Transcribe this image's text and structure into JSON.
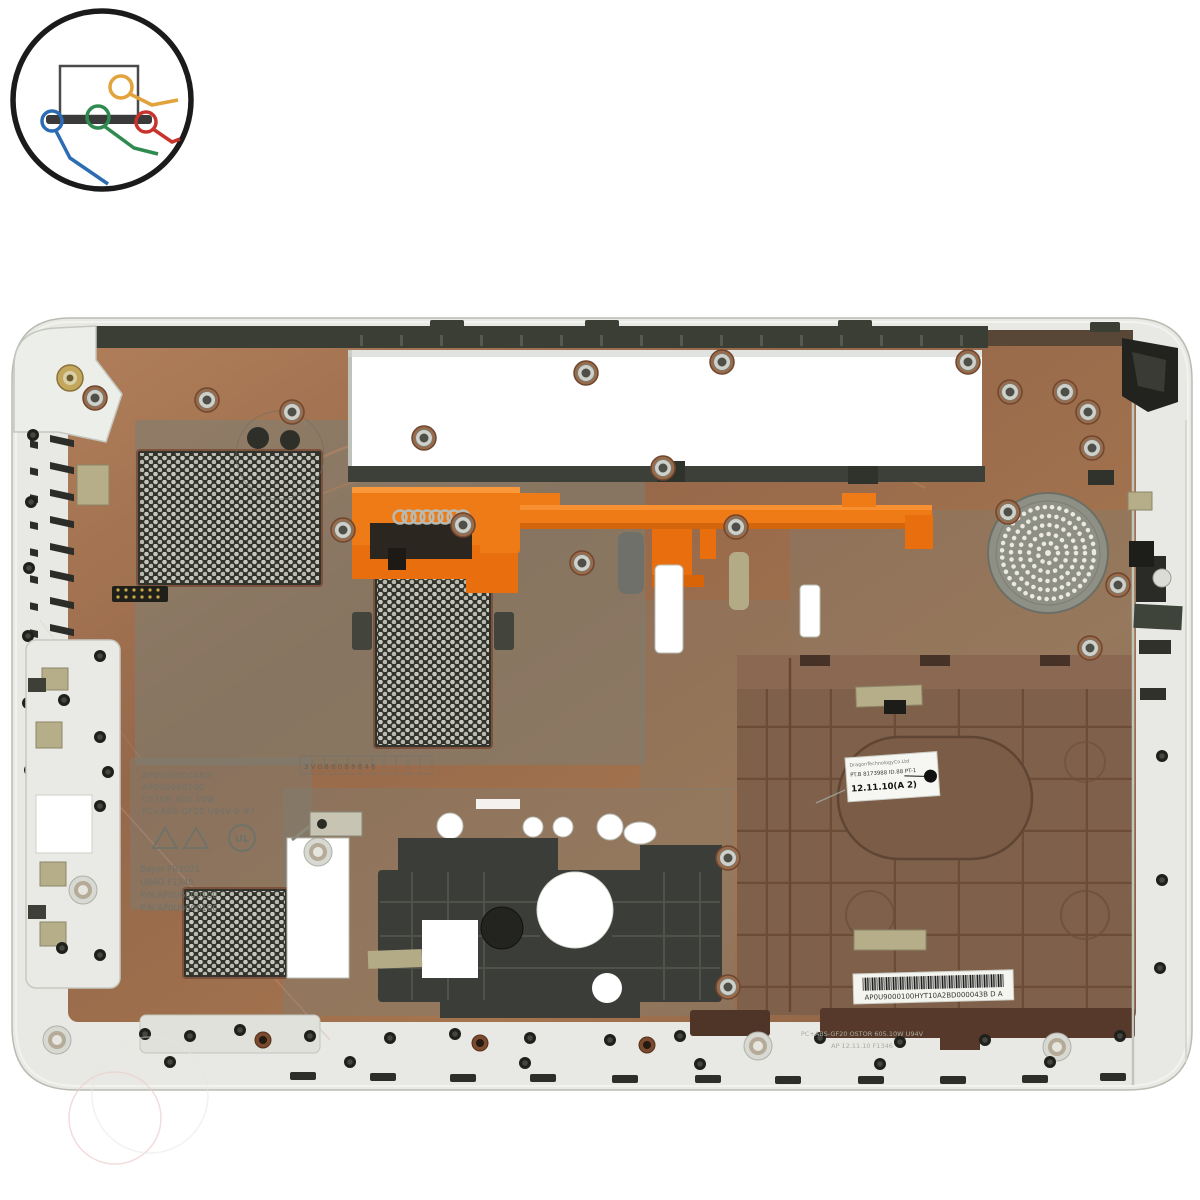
{
  "scene": {
    "background": "#ffffff"
  },
  "logo": {
    "ring": "#1b1b1b",
    "laptop_base": "#3a3a3a",
    "wire_orange": "#e2a23c",
    "wire_green": "#2f8a50",
    "wire_blue": "#2b6cb3",
    "wire_red": "#c8342c"
  },
  "palette": {
    "case_plastic": "#e8e9e4",
    "copper_shield": "#a4734f",
    "magnesium_panel": "#7e8177",
    "latch_orange": "#ee7b16",
    "vent_black": "#32332c",
    "battery_bay_brown": "#7f604b"
  },
  "labels": {
    "sticker_line1": "DragonTechnologyCo.Ltd",
    "sticker_line2": "PT.B 8173988 ID.88 PT-1",
    "sticker_line3": "12.11.10(A 2)",
    "barcode_text": "AP0U9000100HYT10A2BD000043B  D A",
    "molded_line1": "AP0U6000C4B0-",
    "molded_line2": "AP0U9000100",
    "molded_line3": "OSTOR 605.10W",
    "molded_line4": "PC+ABS-GF20 U94V-0  #7",
    "molded_ul": "UL",
    "molded_mat1": "Bayer  FR3021",
    "molded_mat2": "UBAO  F1346",
    "molded_mat3": "P/N:AP0U6000100",
    "molded_mat4": "P/N:AP0U9000100",
    "date_strip": "3 V 0 8 8 0 8 8 8 4 6",
    "bottom_molded_1": "PC+ABS-GF20    OSTOR 605.10W    U94V",
    "bottom_molded_2": "AP  12.11.10    F1346"
  }
}
